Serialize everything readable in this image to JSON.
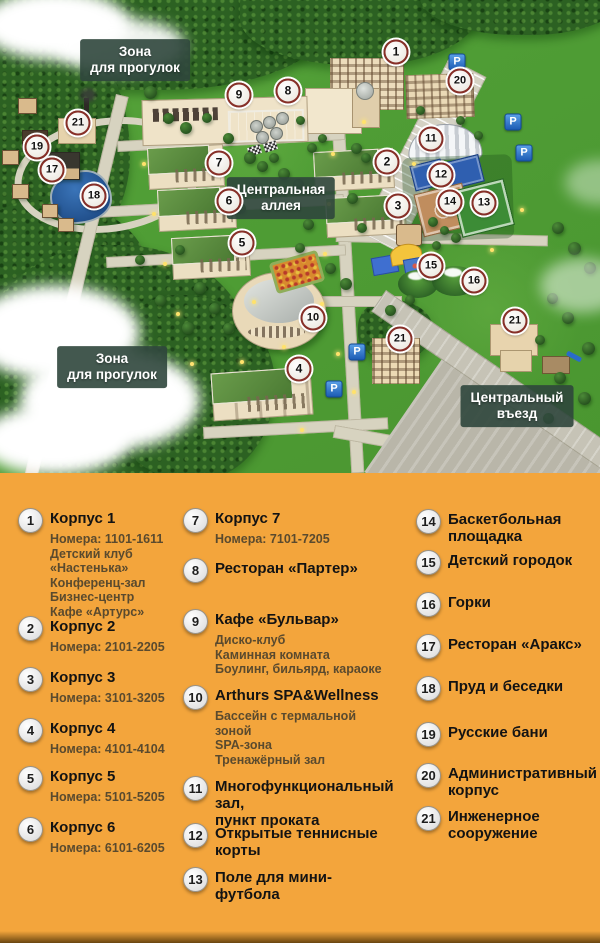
{
  "map": {
    "labels": [
      {
        "id": "zone-walk-top",
        "text": "Зона\nдля прогулок",
        "x": 135,
        "y": 60
      },
      {
        "id": "central-alley",
        "text": "Центральная\nаллея",
        "x": 281,
        "y": 198
      },
      {
        "id": "zone-walk-bottom",
        "text": "Зона\nдля прогулок",
        "x": 112,
        "y": 367
      },
      {
        "id": "central-entrance",
        "text": "Центральный\nвъезд",
        "x": 517,
        "y": 406
      }
    ],
    "markers": [
      {
        "n": "1",
        "x": 396,
        "y": 52
      },
      {
        "n": "2",
        "x": 387,
        "y": 162
      },
      {
        "n": "3",
        "x": 398,
        "y": 206
      },
      {
        "n": "4",
        "x": 299,
        "y": 369
      },
      {
        "n": "5",
        "x": 242,
        "y": 243
      },
      {
        "n": "6",
        "x": 229,
        "y": 201
      },
      {
        "n": "7",
        "x": 219,
        "y": 163
      },
      {
        "n": "8",
        "x": 288,
        "y": 91
      },
      {
        "n": "9",
        "x": 239,
        "y": 95
      },
      {
        "n": "10",
        "x": 313,
        "y": 318
      },
      {
        "n": "11",
        "x": 431,
        "y": 139
      },
      {
        "n": "12",
        "x": 441,
        "y": 175
      },
      {
        "n": "13",
        "x": 484,
        "y": 203
      },
      {
        "n": "14",
        "x": 450,
        "y": 202
      },
      {
        "n": "15",
        "x": 431,
        "y": 266
      },
      {
        "n": "16",
        "x": 474,
        "y": 281
      },
      {
        "n": "17",
        "x": 52,
        "y": 170
      },
      {
        "n": "18",
        "x": 94,
        "y": 196
      },
      {
        "n": "19",
        "x": 37,
        "y": 147
      },
      {
        "n": "20",
        "x": 460,
        "y": 81
      },
      {
        "n": "21",
        "x": 78,
        "y": 123
      },
      {
        "n": "21",
        "x": 400,
        "y": 339
      },
      {
        "n": "21",
        "x": 515,
        "y": 321
      }
    ],
    "parking": {
      "symbol": "P",
      "positions": [
        {
          "x": 457,
          "y": 62
        },
        {
          "x": 513,
          "y": 122
        },
        {
          "x": 524,
          "y": 153
        },
        {
          "x": 357,
          "y": 352
        },
        {
          "x": 334,
          "y": 389
        }
      ]
    }
  },
  "legend": {
    "items": [
      {
        "n": "1",
        "title": "Корпус 1",
        "details": [
          "Номера: 1101-1611",
          "Детский клуб «Настенька»",
          "Конференц-зал",
          "Бизнес-центр",
          "Кафе «Артурс»"
        ]
      },
      {
        "n": "2",
        "title": "Корпус 2",
        "details": [
          "Номера: 2101-2205"
        ]
      },
      {
        "n": "3",
        "title": "Корпус 3",
        "details": [
          "Номера: 3101-3205"
        ]
      },
      {
        "n": "4",
        "title": "Корпус 4",
        "details": [
          "Номера: 4101-4104"
        ]
      },
      {
        "n": "5",
        "title": "Корпус 5",
        "details": [
          "Номера: 5101-5205"
        ]
      },
      {
        "n": "6",
        "title": "Корпус 6",
        "details": [
          "Номера: 6101-6205"
        ]
      },
      {
        "n": "7",
        "title": "Корпус 7",
        "details": [
          "Номера: 7101-7205"
        ]
      },
      {
        "n": "8",
        "title": "Ресторан «Партер»",
        "details": []
      },
      {
        "n": "9",
        "title": "Кафе «Бульвар»",
        "details": [
          "Диско-клуб",
          "Каминная комната",
          "Боулинг, бильярд, караоке"
        ]
      },
      {
        "n": "10",
        "title": "Arthurs SPA&Wellness",
        "details": [
          "Бассейн с термальной зоной",
          "SPA-зона",
          "Тренажёрный зал"
        ]
      },
      {
        "n": "11",
        "title": "Многофункциональный зал,\nпункт проката",
        "details": []
      },
      {
        "n": "12",
        "title": "Открытые теннисные корты",
        "details": []
      },
      {
        "n": "13",
        "title": "Поле для мини-футбола",
        "details": []
      },
      {
        "n": "14",
        "title": "Баскетбольная\nплощадка",
        "details": []
      },
      {
        "n": "15",
        "title": "Детский городок",
        "details": []
      },
      {
        "n": "16",
        "title": "Горки",
        "details": []
      },
      {
        "n": "17",
        "title": "Ресторан «Аракс»",
        "details": []
      },
      {
        "n": "18",
        "title": "Пруд и беседки",
        "details": []
      },
      {
        "n": "19",
        "title": "Русские бани",
        "details": []
      },
      {
        "n": "20",
        "title": "Административный\nкорпус",
        "details": []
      },
      {
        "n": "21",
        "title": "Инженерное\nсооружение",
        "details": []
      }
    ]
  },
  "colors": {
    "legend_bg": "#f3a53c",
    "grass": "#4f9d35",
    "forest": "#2c6122",
    "road": "#d7d3c0",
    "marker_ring": "#872f28",
    "parking_blue": "#2a6cc8",
    "pond": "#2d63a8",
    "roof_green": "#5c8a3e",
    "wall_cream": "#ecdfc2"
  }
}
